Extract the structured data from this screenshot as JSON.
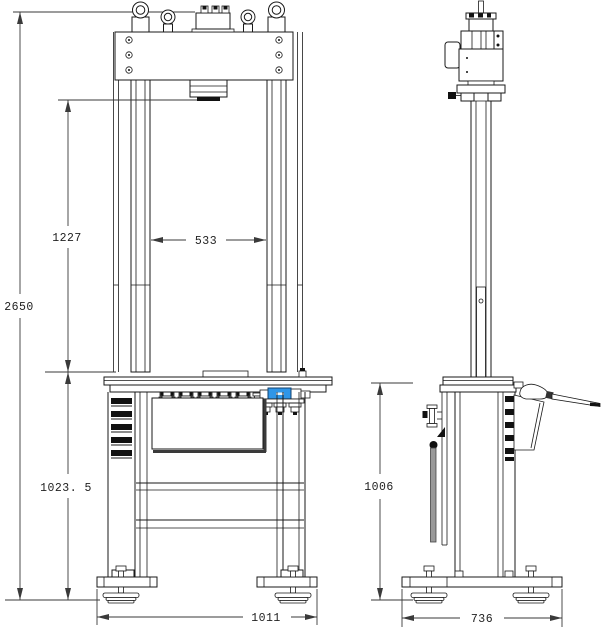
{
  "dims": {
    "overall_height": "2650",
    "ram_to_table": "1227",
    "column_spacing": "533",
    "table_to_floor": "1023. 5",
    "front_base_width": "1011",
    "side_table_height": "1006",
    "side_base_depth": "736"
  },
  "colors": {
    "line": "#1a1a1a",
    "dimension": "#3a3a3a",
    "accent_blue": "#2f96e8",
    "strut_gray": "#999999",
    "window_shadow": "#3a3a3a"
  }
}
